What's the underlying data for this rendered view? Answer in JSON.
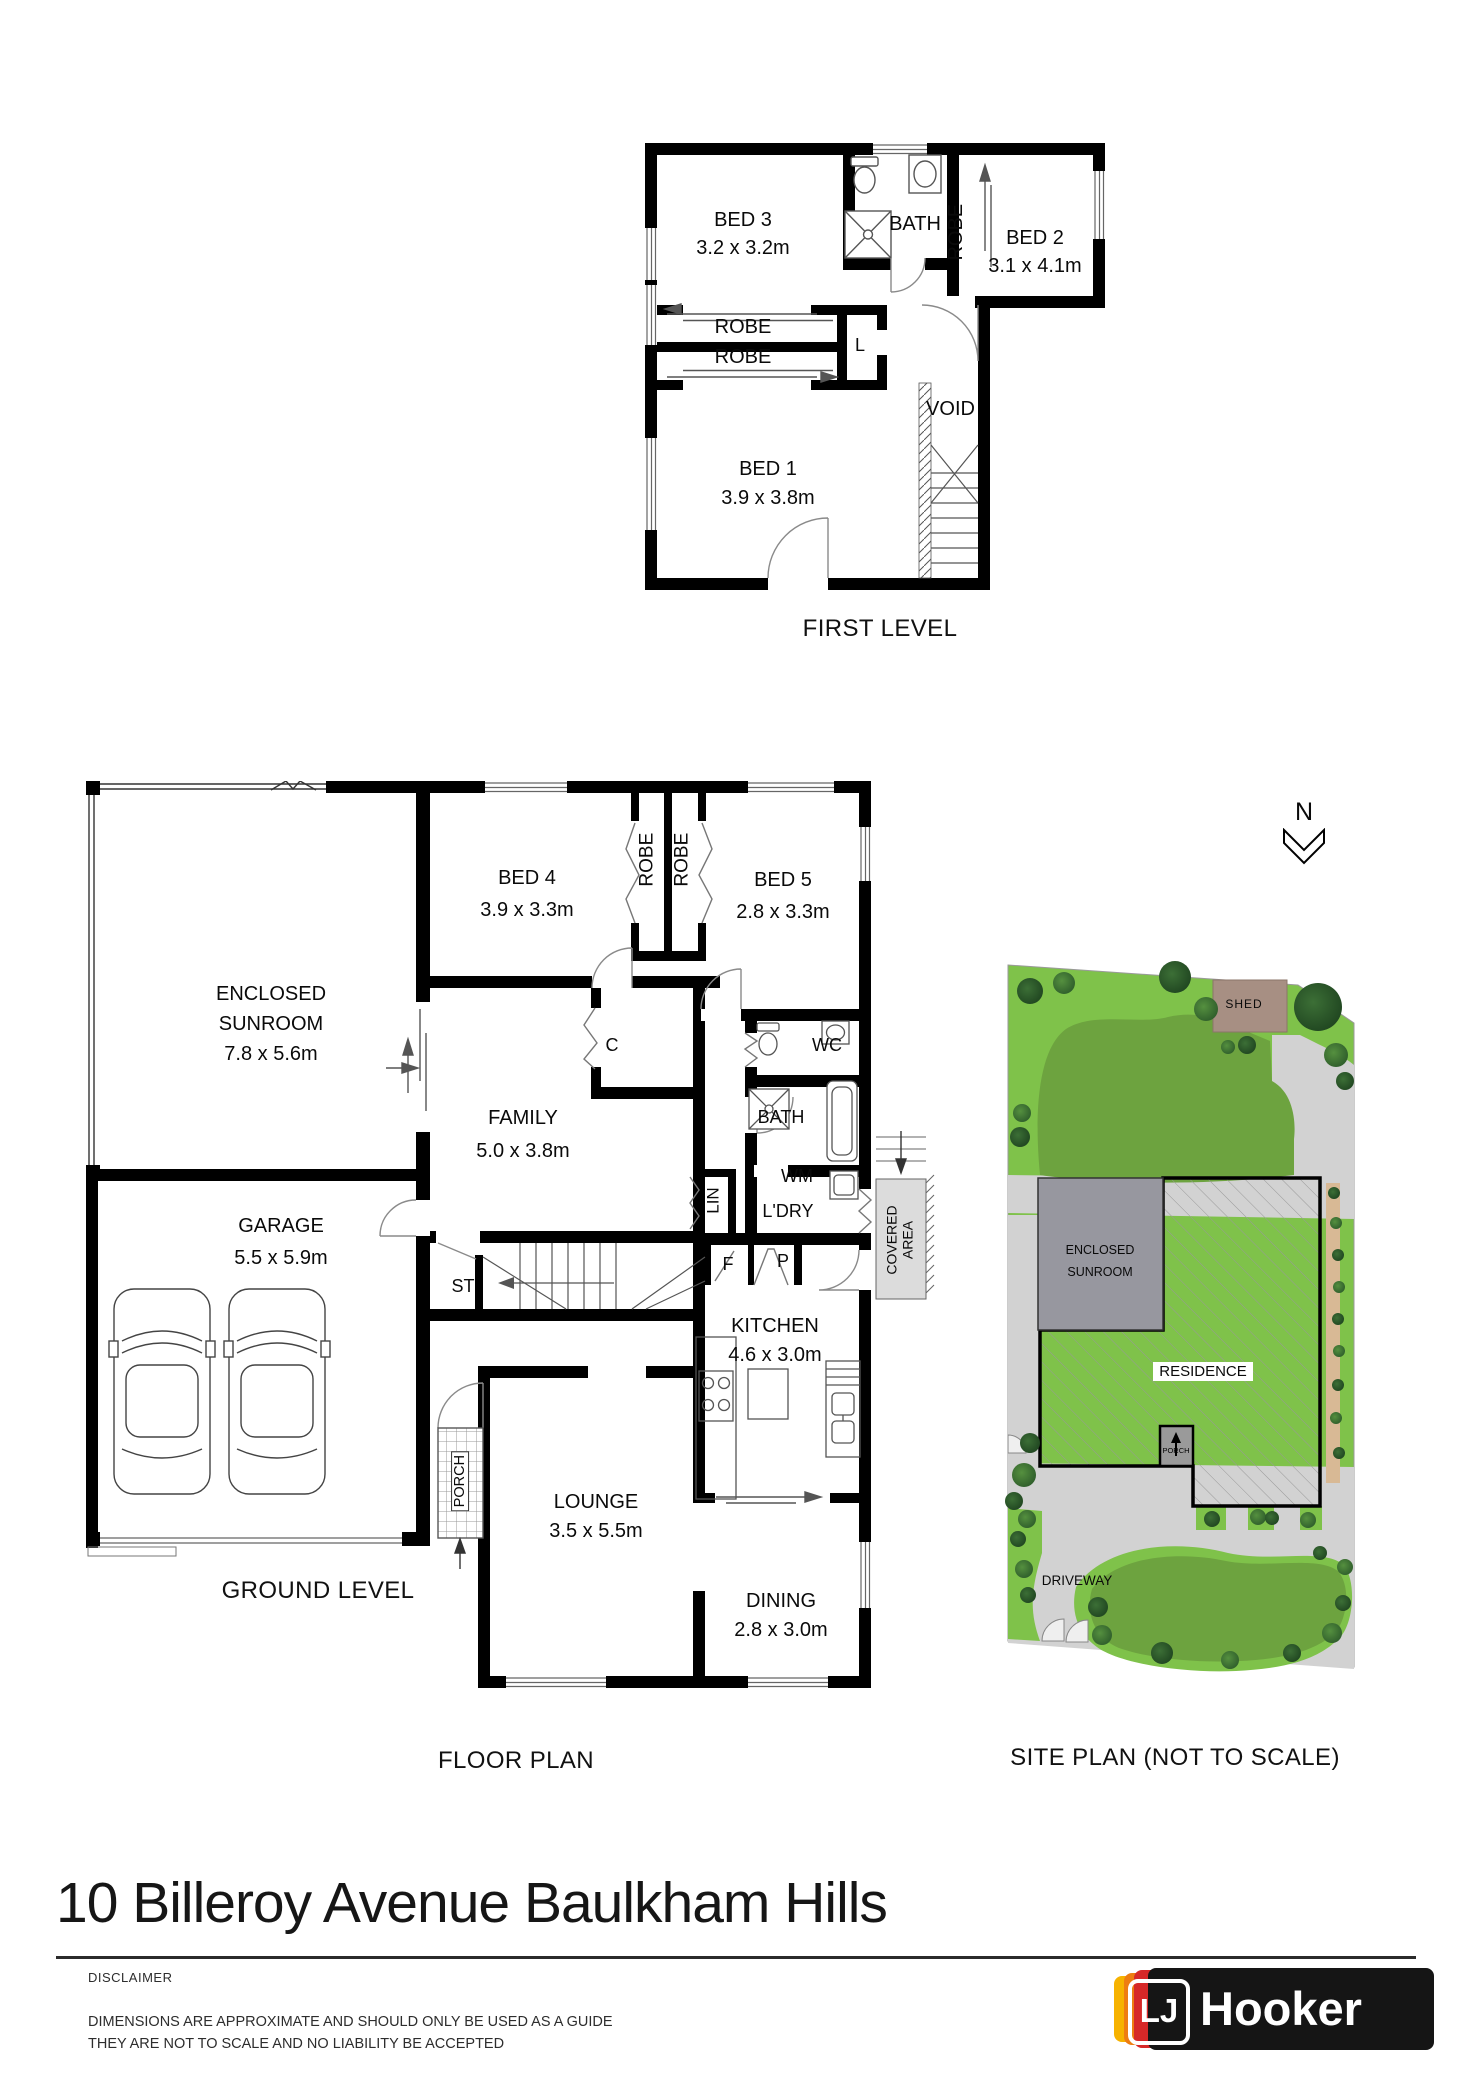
{
  "colors": {
    "wall": "#000000",
    "fixture_line": "#555555",
    "door_line": "#888888",
    "site_light_green": "#7fc24a",
    "site_lawn_green": "#6da33f",
    "site_path_gray": "#d2d2d2",
    "site_shed_brown": "#a78f83",
    "site_sunroom_gray": "#97979f",
    "site_fence_tan": "#d8b995",
    "tree_green": "#2d5b2d",
    "brand_yellow": "#f6b200",
    "brand_orange": "#ee7d11",
    "brand_red": "#d62828",
    "brand_black": "#151515"
  },
  "first_level": {
    "title": "FIRST LEVEL",
    "bed3": {
      "name": "BED 3",
      "dims": "3.2 x 3.2m"
    },
    "bath": "BATH",
    "robe_bed2": "ROBE",
    "bed2": {
      "name": "BED 2",
      "dims": "3.1 x 4.1m"
    },
    "robe_top": "ROBE",
    "robe_bottom": "ROBE",
    "linen": "L",
    "void": "VOID",
    "bed1": {
      "name": "BED 1",
      "dims": "3.9 x 3.8m"
    }
  },
  "ground_level": {
    "title": "GROUND LEVEL",
    "plan_caption": "FLOOR PLAN",
    "sunroom": {
      "line1": "ENCLOSED",
      "line2": "SUNROOM",
      "dims": "7.8 x 5.6m"
    },
    "bed4": {
      "name": "BED 4",
      "dims": "3.9 x 3.3m"
    },
    "robe_left": "ROBE",
    "robe_right": "ROBE",
    "bed5": {
      "name": "BED 5",
      "dims": "2.8 x 3.3m"
    },
    "wc": "WC",
    "closet": "C",
    "family": {
      "name": "FAMILY",
      "dims": "5.0 x 3.8m"
    },
    "bath": "BATH",
    "wm": "WM",
    "lin": "LIN",
    "ldry": "L'DRY",
    "garage": {
      "name": "GARAGE",
      "dims": "5.5 x 5.9m"
    },
    "st": "ST",
    "fridge": "F",
    "pantry": "P",
    "covered": {
      "line1": "COVERED",
      "line2": "AREA"
    },
    "kitchen": {
      "name": "KITCHEN",
      "dims": "4.6 x 3.0m"
    },
    "porch": "PORCH",
    "lounge": {
      "name": "LOUNGE",
      "dims": "3.5 x 5.5m"
    },
    "dining": {
      "name": "DINING",
      "dims": "2.8 x 3.0m"
    }
  },
  "site_plan": {
    "caption": "SITE PLAN (NOT TO SCALE)",
    "north": "N",
    "shed": "SHED",
    "sunroom_line1": "ENCLOSED",
    "sunroom_line2": "SUNROOM",
    "residence": "RESIDENCE",
    "porch": "PORCH",
    "driveway": "DRIVEWAY"
  },
  "footer": {
    "address": "10 Billeroy Avenue Baulkham Hills",
    "disclaimer_title": "DISCLAIMER",
    "disclaimer_line1": "DIMENSIONS ARE APPROXIMATE AND SHOULD ONLY BE USED AS A GUIDE",
    "disclaimer_line2": "THEY ARE NOT TO SCALE AND NO LIABILITY BE ACCEPTED",
    "brand_lj": "LJ",
    "brand_name": "Hooker"
  }
}
